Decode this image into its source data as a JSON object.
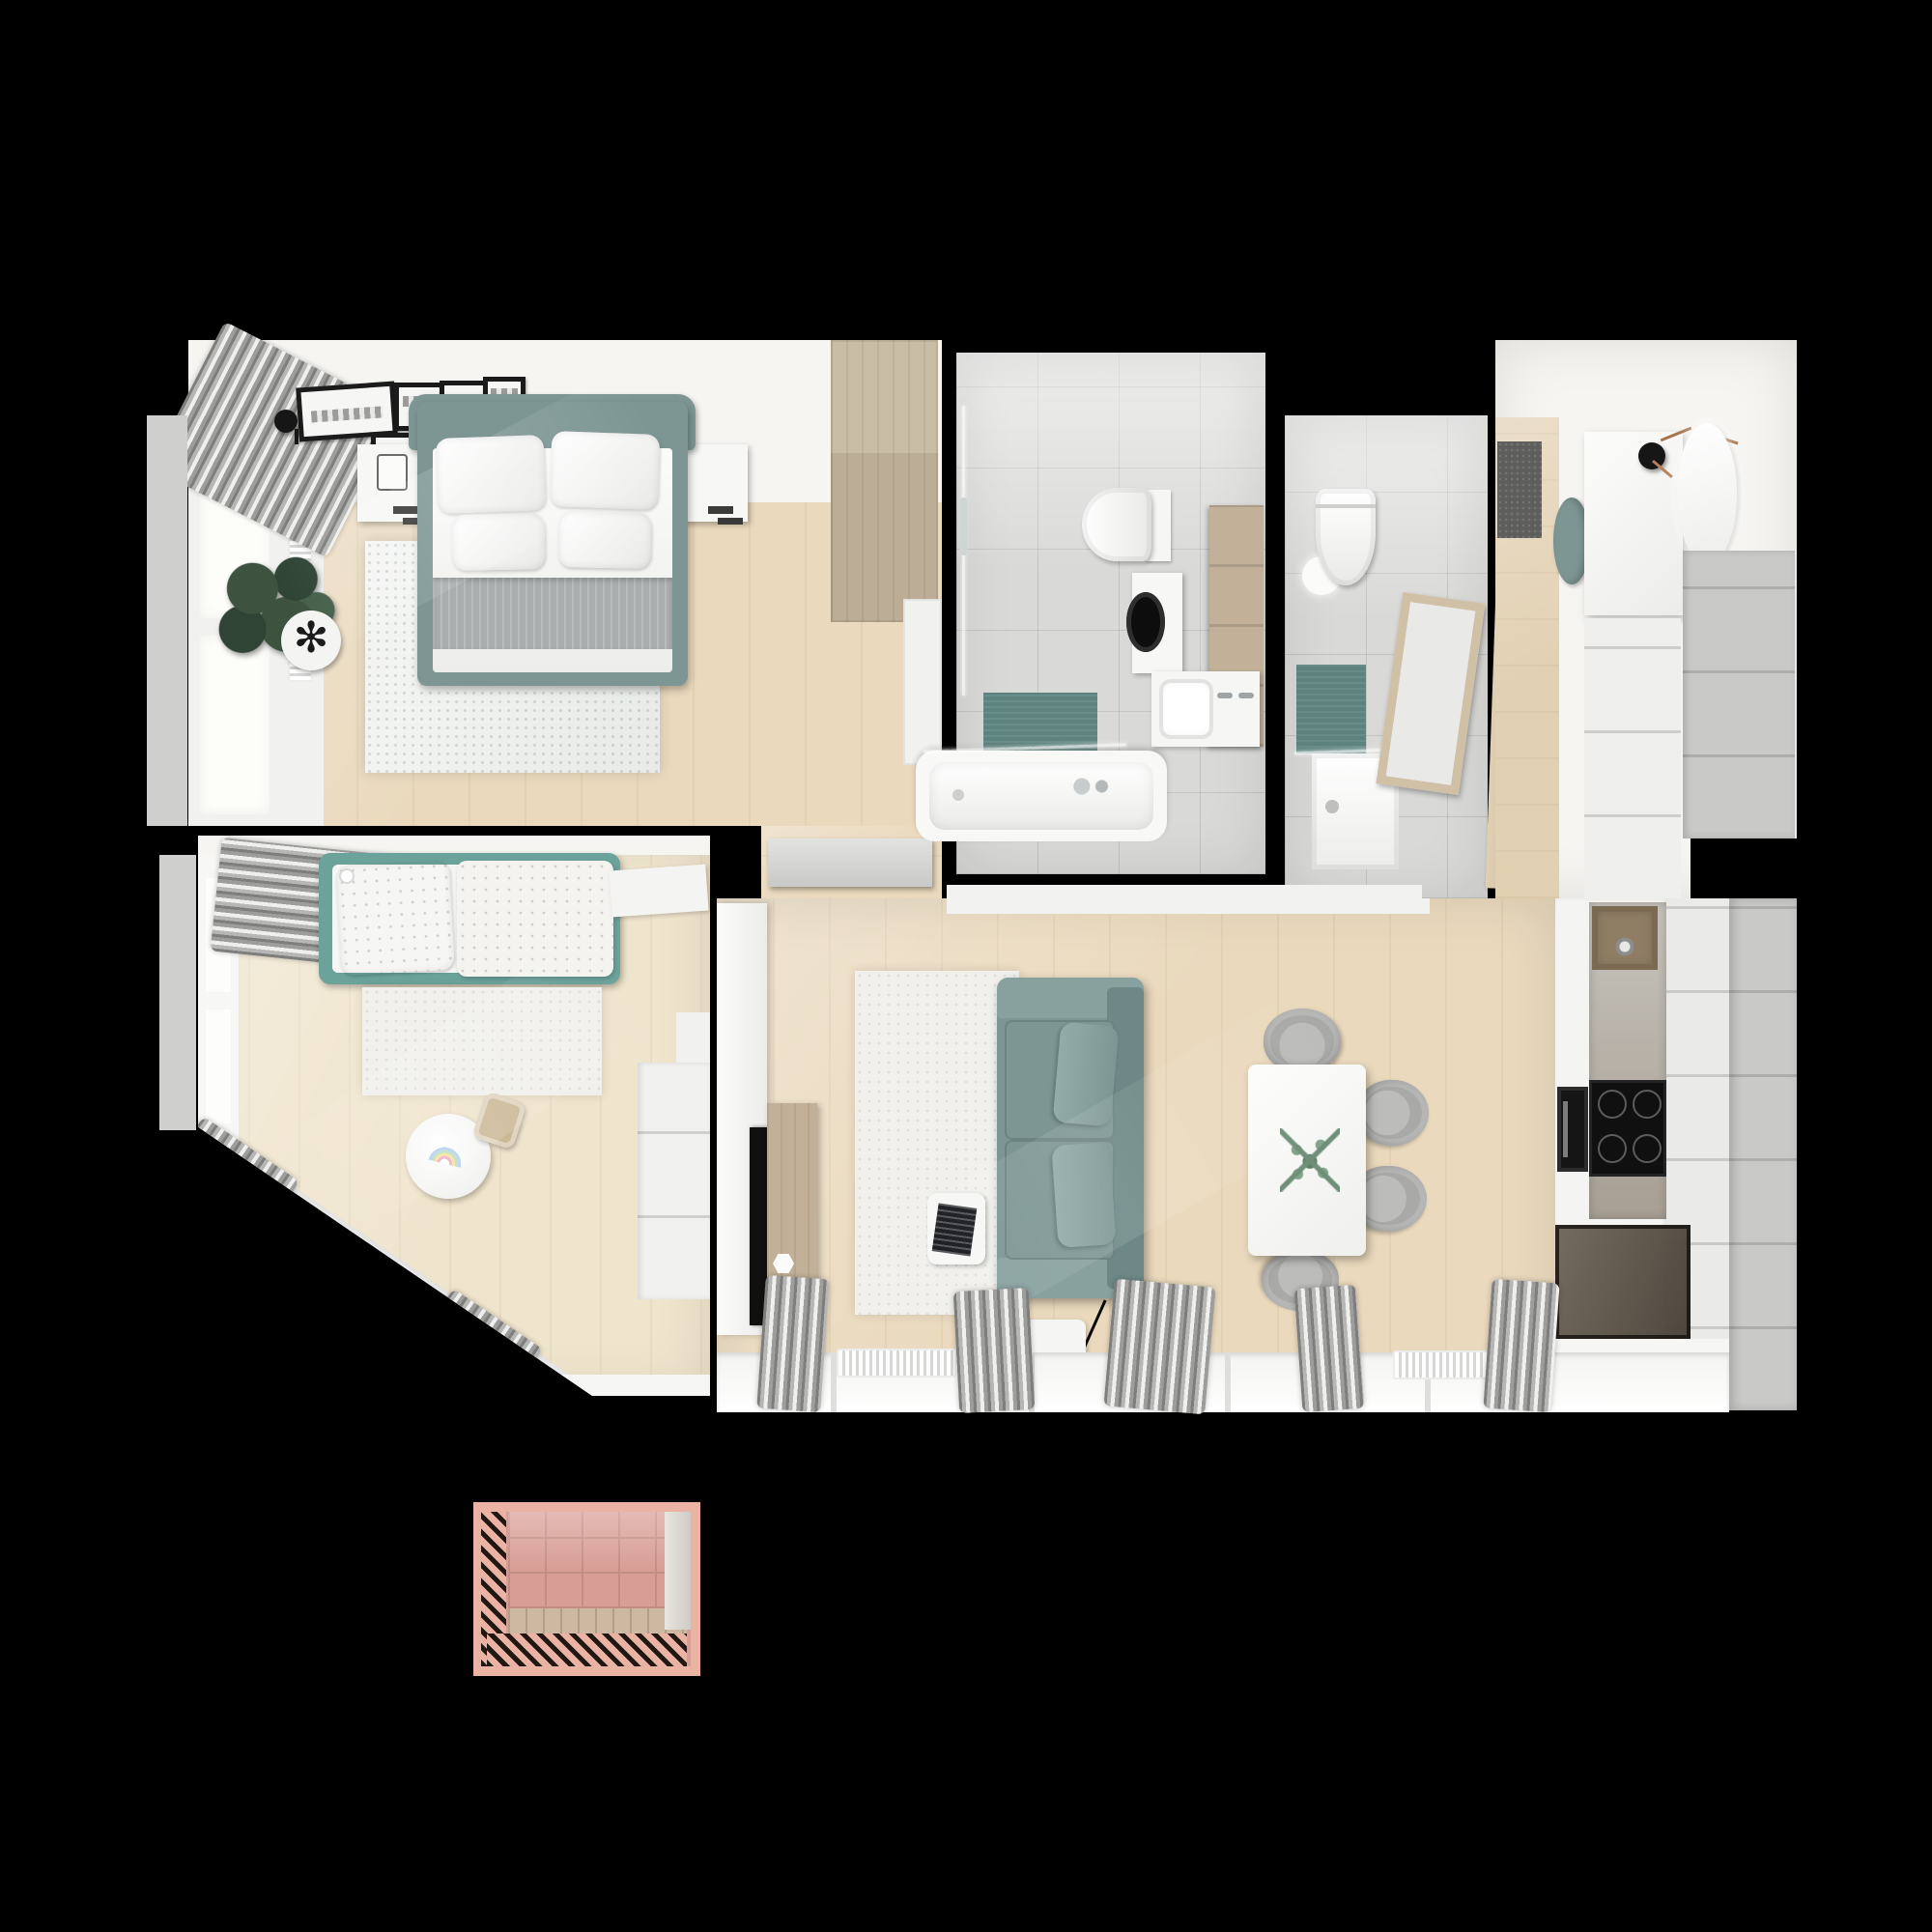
{
  "scene": {
    "title": "apartment-floor-plan-top-down-render",
    "view": "top-down 3d render",
    "background": "#000000"
  },
  "palette": {
    "background": "#000000",
    "wall-white": "#f6f5f2",
    "floor-wood": "#ead9bd",
    "floor-wood-light": "#f6ecd9",
    "tile": "#d9d9d7",
    "teal-sofa": "#7d9694",
    "teal-dark": "#6d8886",
    "teal-kids": "#6ba39b",
    "teal-mat": "#5e837f",
    "curtain-gray": "#9a9a98",
    "rug-white": "#f1f0ec",
    "rug-bedroom": "#e7eae6",
    "wood-furniture": "#c2b198",
    "doormat-gray": "#5e5e5c",
    "chair-gray": "#a9a9a7",
    "cabinet-white": "#efefed",
    "cabinet-gray": "#c9c9c7",
    "counter-white": "#f4f4f2",
    "backsplash-gray": "#b5b1aa",
    "glass-smoke": "#6e6458",
    "blanket-gray": "#a9adad",
    "appliance-black": "#151515",
    "balcony-frame-pink": "#eab3a3",
    "balcony-tile-pink": "#d89e95",
    "balcony-grout-pink": "#c28d85",
    "balcony-floor": "#cdb9a2",
    "plant-green": "#3d5340",
    "sprig-green": "#84a58c"
  },
  "rooms": [
    {
      "id": "master-bedroom",
      "name": "Master bedroom",
      "furniture": [
        "double bed with teal frame",
        "4 white pillows",
        "gray foot blanket",
        "2 white nightstands",
        "gallery wall of 7 black picture frames",
        "2 black wall sconces",
        "gray rug",
        "potted plant",
        "wood wardrobe",
        "window with gray curtain",
        "radiator"
      ]
    },
    {
      "id": "kids-bedroom",
      "name": "Kids bedroom",
      "furniture": [
        "single bed with teal frame",
        "polka-dot duvet",
        "white rug",
        "round kids table with rainbow drawing",
        "wood chair",
        "white wardrobe",
        "white desk",
        "angled window wall with gray curtains",
        "radiator"
      ]
    },
    {
      "id": "bathroom-main",
      "name": "Main bathroom",
      "furniture": [
        "bathtub with glass screen",
        "toilet",
        "washing machine",
        "vanity sink with two faucets",
        "wood shelf unit",
        "teal bath mat",
        "glass shower door"
      ]
    },
    {
      "id": "shower-room",
      "name": "Shower room",
      "furniture": [
        "toilet",
        "shower tray with teal wall panel",
        "framed mirror",
        "ceiling lamp",
        "wood door"
      ]
    },
    {
      "id": "entry-hall",
      "name": "Entry hall",
      "furniture": [
        "dark doormat",
        "teal pouf",
        "white console",
        "two black coat hooks with twigs",
        "round mirror",
        "gray wardrobe"
      ]
    },
    {
      "id": "living-room",
      "name": "Living room",
      "furniture": [
        "teal sofa with two pillows",
        "armrest tray with laptop",
        "white rug",
        "white side table",
        "white dining table with eucalyptus sprig",
        "4 gray shell chairs",
        "tv panel with tv",
        "wood media console",
        "windows with gray curtains",
        "2 radiators"
      ]
    },
    {
      "id": "kitchen",
      "name": "Kitchen",
      "furniture": [
        "white cabinet run",
        "gray backsplash",
        "bronze sink with faucet",
        "induction cooktop",
        "built-in oven",
        "smoked-glass cabinet",
        "tall gray cabinets"
      ]
    },
    {
      "id": "hallway",
      "name": "Hallway",
      "furniture": [
        "gray sideboard",
        "white closet"
      ]
    },
    {
      "id": "balcony",
      "name": "Balcony",
      "furniture": [
        "pink tiled walls",
        "slatted pergola bands",
        "plank floor"
      ]
    }
  ]
}
